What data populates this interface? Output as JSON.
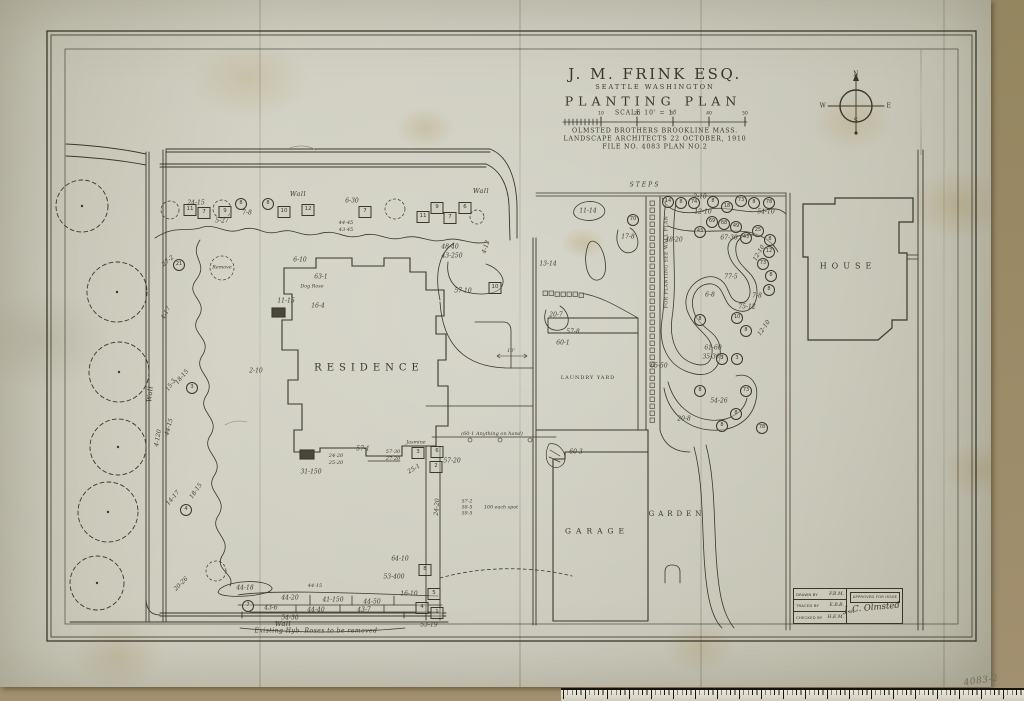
{
  "title_block": {
    "client": "J. M. FRINK  ESQ.",
    "location": "SEATTLE    WASHINGTON",
    "title": "PLANTING  PLAN",
    "scale_label": "SCALE  10' = 1\"",
    "firm_line1": "OLMSTED BROTHERS BROOKLINE MASS.",
    "firm_line2": "LANDSCAPE ARCHITECTS 22 OCTOBER, 1910",
    "file_line": "FILE NO. 4083    PLAN NO.2"
  },
  "compass": {
    "n": "N",
    "e": "E",
    "s": "S",
    "w": "W"
  },
  "approval": {
    "drawn_label": "DRAWN BY",
    "drawn_value": "F.B.M.",
    "traced_label": "TRACED BY",
    "traced_value": "E.B.B.",
    "checked_label": "CHECKED BY",
    "checked_value": "H.E.M.",
    "approved_label": "APPROVED FOR ISSUE",
    "by_label": "BY",
    "signature": "J. C. Olmsted"
  },
  "sheet_number": "4083-2",
  "ink_color": "#3b382b",
  "paper_color": "#c6c5b6",
  "scale_ticks": [
    {
      "t": "10",
      "x": 601,
      "y": 114
    },
    {
      "t": "20",
      "x": 637,
      "y": 114
    },
    {
      "t": "30",
      "x": 673,
      "y": 114
    },
    {
      "t": "40",
      "x": 709,
      "y": 114
    },
    {
      "t": "50",
      "x": 745,
      "y": 114
    }
  ],
  "area_labels": [
    {
      "t": "RESIDENCE",
      "x": 369,
      "y": 368,
      "size": 10,
      "ls": 5,
      "cls": "hand"
    },
    {
      "t": "HOUSE",
      "x": 848,
      "y": 266,
      "size": 8,
      "ls": 5,
      "cls": "hand"
    },
    {
      "t": "GARAGE",
      "x": 597,
      "y": 531,
      "size": 7.5,
      "ls": 5,
      "cls": "hand"
    },
    {
      "t": "GARDEN",
      "x": 677,
      "y": 514,
      "size": 7,
      "ls": 4,
      "cls": "hand"
    },
    {
      "t": "LAUNDRY YARD",
      "x": 588,
      "y": 378,
      "size": 5,
      "ls": 1,
      "cls": "hand"
    },
    {
      "t": "STEPS",
      "x": 645,
      "y": 185,
      "size": 6,
      "ls": 2,
      "cls": "script"
    },
    {
      "t": "Wall",
      "x": 298,
      "y": 194,
      "size": 6.5,
      "cls": "script"
    },
    {
      "t": "Wall",
      "x": 481,
      "y": 191,
      "size": 6.5,
      "cls": "script"
    },
    {
      "t": "Wall",
      "x": 283,
      "y": 624,
      "size": 6.5,
      "cls": "script"
    },
    {
      "t": "Wall",
      "x": 150,
      "y": 394,
      "size": 6.5,
      "rot": -85,
      "cls": "script"
    },
    {
      "t": "Existing Hyb. Roses to be removed",
      "x": 316,
      "y": 631,
      "size": 6,
      "cls": "script"
    },
    {
      "t": "FOR PLANTING SEE WALL PLAN",
      "x": 667,
      "y": 262,
      "size": 4.6,
      "rot": -90,
      "cls": "hand"
    },
    {
      "t": "4083-2",
      "x": 981,
      "y": 681,
      "size": 9,
      "rot": -8,
      "cls": "pencil"
    }
  ],
  "plant_codes": [
    {
      "t": "24-15",
      "x": 196,
      "y": 203
    },
    {
      "t": "5-27",
      "x": 222,
      "y": 221
    },
    {
      "t": "7-8",
      "x": 247,
      "y": 213
    },
    {
      "t": "27-2",
      "x": 168,
      "y": 261,
      "rot": -40
    },
    {
      "t": "6-30",
      "x": 352,
      "y": 201
    },
    {
      "t": "44-45",
      "x": 346,
      "y": 223,
      "size": 5
    },
    {
      "t": "43-45",
      "x": 346,
      "y": 230,
      "size": 5
    },
    {
      "t": "48-40",
      "x": 450,
      "y": 247
    },
    {
      "t": "43-250",
      "x": 452,
      "y": 256
    },
    {
      "t": "4-12",
      "x": 486,
      "y": 247,
      "rot": -72
    },
    {
      "t": "57-10",
      "x": 463,
      "y": 291
    },
    {
      "t": "6-10",
      "x": 300,
      "y": 260
    },
    {
      "t": "63-1",
      "x": 321,
      "y": 277
    },
    {
      "t": "Dog Rose",
      "x": 312,
      "y": 287,
      "size": 4.8
    },
    {
      "t": "11-15",
      "x": 286,
      "y": 301
    },
    {
      "t": "16-4",
      "x": 318,
      "y": 306
    },
    {
      "t": "Remove",
      "x": 222,
      "y": 268,
      "size": 4.8
    },
    {
      "t": "4-17",
      "x": 166,
      "y": 313,
      "rot": -62
    },
    {
      "t": "18-15",
      "x": 182,
      "y": 377,
      "rot": -50
    },
    {
      "t": "15-3",
      "x": 171,
      "y": 385,
      "rot": -55
    },
    {
      "t": "44-15",
      "x": 169,
      "y": 427,
      "rot": -75
    },
    {
      "t": "4-120",
      "x": 158,
      "y": 438,
      "rot": -80
    },
    {
      "t": "14-17",
      "x": 173,
      "y": 498,
      "rot": -50
    },
    {
      "t": "18-15",
      "x": 196,
      "y": 491,
      "rot": -55
    },
    {
      "t": "20-26",
      "x": 181,
      "y": 584,
      "rot": -45
    },
    {
      "t": "2-10",
      "x": 256,
      "y": 371
    },
    {
      "t": "57-1",
      "x": 363,
      "y": 449
    },
    {
      "t": "24-20",
      "x": 336,
      "y": 456,
      "size": 5
    },
    {
      "t": "25-20",
      "x": 336,
      "y": 463,
      "size": 5
    },
    {
      "t": "31-150",
      "x": 311,
      "y": 472
    },
    {
      "t": "57-30",
      "x": 393,
      "y": 452,
      "size": 5
    },
    {
      "t": "27-20",
      "x": 393,
      "y": 459,
      "size": 5
    },
    {
      "t": "57-20",
      "x": 452,
      "y": 461
    },
    {
      "t": "25-1",
      "x": 414,
      "y": 469,
      "rot": -30
    },
    {
      "t": "24-20",
      "x": 437,
      "y": 507,
      "rot": -85
    },
    {
      "t": "(60-1  Anything on hand)",
      "x": 492,
      "y": 434,
      "size": 5
    },
    {
      "t": "Jasmine",
      "x": 416,
      "y": 443,
      "size": 4.8
    },
    {
      "t": "57-2",
      "x": 467,
      "y": 502,
      "size": 4.8
    },
    {
      "t": "58-5",
      "x": 467,
      "y": 508,
      "size": 4.8
    },
    {
      "t": "59-5",
      "x": 467,
      "y": 514,
      "size": 4.8
    },
    {
      "t": "100 each spot",
      "x": 501,
      "y": 508,
      "size": 4.8
    },
    {
      "t": "60-3",
      "x": 576,
      "y": 452
    },
    {
      "t": "10'",
      "x": 511,
      "y": 351,
      "size": 5
    },
    {
      "t": "44-18",
      "x": 245,
      "y": 588
    },
    {
      "t": "44-15",
      "x": 315,
      "y": 586,
      "size": 5
    },
    {
      "t": "44-20",
      "x": 290,
      "y": 598
    },
    {
      "t": "41-150",
      "x": 333,
      "y": 600
    },
    {
      "t": "44-50",
      "x": 372,
      "y": 602
    },
    {
      "t": "43-6",
      "x": 271,
      "y": 608
    },
    {
      "t": "44-40",
      "x": 316,
      "y": 610
    },
    {
      "t": "43-7",
      "x": 364,
      "y": 610
    },
    {
      "t": "54-30",
      "x": 290,
      "y": 618
    },
    {
      "t": "53-400",
      "x": 394,
      "y": 577
    },
    {
      "t": "16-10",
      "x": 409,
      "y": 594
    },
    {
      "t": "64-10",
      "x": 400,
      "y": 559
    },
    {
      "t": "53-19",
      "x": 429,
      "y": 625
    },
    {
      "t": "11-14",
      "x": 588,
      "y": 211
    },
    {
      "t": "17-8",
      "x": 628,
      "y": 237
    },
    {
      "t": "13-14",
      "x": 548,
      "y": 264
    },
    {
      "t": "20-7",
      "x": 556,
      "y": 315
    },
    {
      "t": "57-8",
      "x": 573,
      "y": 332
    },
    {
      "t": "60-1",
      "x": 563,
      "y": 343
    },
    {
      "t": "2-10",
      "x": 700,
      "y": 197
    },
    {
      "t": "12-10",
      "x": 703,
      "y": 212
    },
    {
      "t": "54-10",
      "x": 766,
      "y": 212
    },
    {
      "t": "67-30",
      "x": 729,
      "y": 238
    },
    {
      "t": "48-20",
      "x": 674,
      "y": 240
    },
    {
      "t": "77-5",
      "x": 731,
      "y": 277
    },
    {
      "t": "12-10",
      "x": 759,
      "y": 253,
      "rot": -60
    },
    {
      "t": "7-8",
      "x": 757,
      "y": 296
    },
    {
      "t": "6-8",
      "x": 710,
      "y": 295
    },
    {
      "t": "75-12",
      "x": 747,
      "y": 307
    },
    {
      "t": "12-10",
      "x": 764,
      "y": 328,
      "rot": -55
    },
    {
      "t": "61-60",
      "x": 713,
      "y": 348
    },
    {
      "t": "35-300",
      "x": 713,
      "y": 357
    },
    {
      "t": "65-50",
      "x": 659,
      "y": 366
    },
    {
      "t": "54-26",
      "x": 719,
      "y": 401
    },
    {
      "t": "20-8",
      "x": 684,
      "y": 419
    }
  ],
  "circle_markers": [
    {
      "t": "8",
      "x": 241,
      "y": 204
    },
    {
      "t": "8",
      "x": 268,
      "y": 204
    },
    {
      "t": "21",
      "x": 179,
      "y": 265
    },
    {
      "t": "3",
      "x": 192,
      "y": 388
    },
    {
      "t": "4",
      "x": 186,
      "y": 510
    },
    {
      "t": "7",
      "x": 248,
      "y": 606
    },
    {
      "t": "14",
      "x": 668,
      "y": 202
    },
    {
      "t": "8",
      "x": 681,
      "y": 203
    },
    {
      "t": "74",
      "x": 694,
      "y": 203
    },
    {
      "t": "8",
      "x": 713,
      "y": 202
    },
    {
      "t": "18",
      "x": 727,
      "y": 207
    },
    {
      "t": "73",
      "x": 741,
      "y": 201
    },
    {
      "t": "8",
      "x": 754,
      "y": 203
    },
    {
      "t": "78",
      "x": 769,
      "y": 203
    },
    {
      "t": "70",
      "x": 633,
      "y": 220
    },
    {
      "t": "69",
      "x": 712,
      "y": 222
    },
    {
      "t": "68",
      "x": 724,
      "y": 224
    },
    {
      "t": "49",
      "x": 736,
      "y": 227
    },
    {
      "t": "43",
      "x": 700,
      "y": 232
    },
    {
      "t": "43",
      "x": 746,
      "y": 238
    },
    {
      "t": "25",
      "x": 758,
      "y": 231
    },
    {
      "t": "8",
      "x": 770,
      "y": 240
    },
    {
      "t": "12",
      "x": 769,
      "y": 252
    },
    {
      "t": "73",
      "x": 763,
      "y": 264
    },
    {
      "t": "8",
      "x": 771,
      "y": 276
    },
    {
      "t": "8",
      "x": 769,
      "y": 290
    },
    {
      "t": "8",
      "x": 700,
      "y": 320
    },
    {
      "t": "10",
      "x": 737,
      "y": 318
    },
    {
      "t": "8",
      "x": 746,
      "y": 331
    },
    {
      "t": "3",
      "x": 722,
      "y": 359
    },
    {
      "t": "3",
      "x": 737,
      "y": 359
    },
    {
      "t": "8",
      "x": 700,
      "y": 391
    },
    {
      "t": "73",
      "x": 746,
      "y": 391
    },
    {
      "t": "8",
      "x": 736,
      "y": 414
    },
    {
      "t": "8",
      "x": 722,
      "y": 426
    },
    {
      "t": "78",
      "x": 762,
      "y": 428
    }
  ],
  "square_markers": [
    {
      "t": "11",
      "x": 190,
      "y": 210
    },
    {
      "t": "7",
      "x": 204,
      "y": 213
    },
    {
      "t": "9",
      "x": 225,
      "y": 212
    },
    {
      "t": "10",
      "x": 284,
      "y": 212
    },
    {
      "t": "12",
      "x": 308,
      "y": 210
    },
    {
      "t": "7",
      "x": 365,
      "y": 212
    },
    {
      "t": "9",
      "x": 437,
      "y": 208
    },
    {
      "t": "6",
      "x": 465,
      "y": 208
    },
    {
      "t": "11",
      "x": 423,
      "y": 217
    },
    {
      "t": "7",
      "x": 450,
      "y": 218
    },
    {
      "t": "10",
      "x": 495,
      "y": 288
    },
    {
      "t": "3",
      "x": 418,
      "y": 453
    },
    {
      "t": "6",
      "x": 437,
      "y": 452
    },
    {
      "t": "2",
      "x": 436,
      "y": 467
    },
    {
      "t": "8",
      "x": 425,
      "y": 570
    },
    {
      "t": "5",
      "x": 434,
      "y": 594
    },
    {
      "t": "4",
      "x": 422,
      "y": 608
    },
    {
      "t": "1",
      "x": 437,
      "y": 613
    }
  ]
}
